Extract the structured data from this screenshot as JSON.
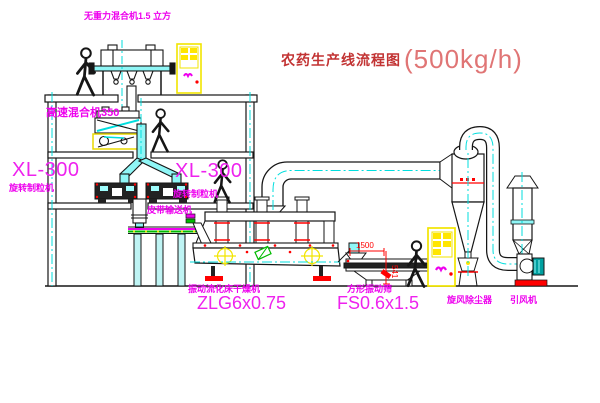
{
  "title": {
    "zh": "农药生产线流程图",
    "capacity": "(500kg/h)"
  },
  "labels": {
    "gravity_mixer": "无重力混合机1.5 立方",
    "high_speed_mixer": "高速混合机350",
    "granulator_model_left": "XL-300",
    "granulator_left": "旋转制粒机",
    "granulator_model_right": "XL-300",
    "granulator_right": "旋转制粒机",
    "belt_conveyor": "皮带输送机",
    "dryer": "振动流化床干燥机",
    "dryer_model": "ZLG6x0.75",
    "screen": "方形振动筛",
    "screen_model": "FS0.6x1.5",
    "cyclone": "旋风除尘器",
    "fan": "引风机"
  },
  "dimensions": {
    "screen_width": "1500",
    "screen_height": "541"
  },
  "colors": {
    "label_magenta": "#ee00ee",
    "title_red": "#c23333",
    "capacity_red": "#e07575",
    "dimension_red": "#ff0000",
    "centerline_cyan": "#00dede",
    "chute_cyan": "#8ff6f6",
    "cabinet_yellow": "#f2e500",
    "conveyor_green": "#00bb00",
    "line_black": "#1a1a1a"
  }
}
